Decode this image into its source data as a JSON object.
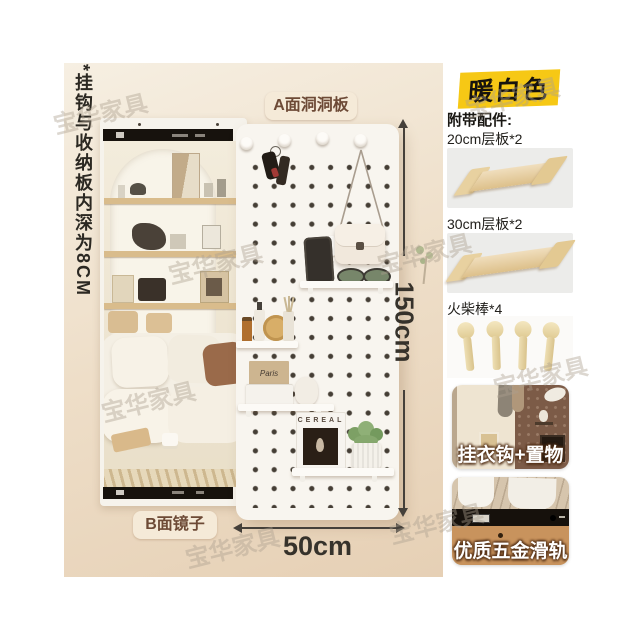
{
  "stage": {
    "side_note": "*挂钩与收纳板内深为8CM",
    "label_front": "A面洞洞板",
    "label_back": "B面镜子",
    "dim_height": "150cm",
    "dim_width": "50cm",
    "cereal_title": "CEREAL",
    "magazine_title": "Paris"
  },
  "sidebar": {
    "color_badge": "暖白色",
    "accessories_title": "附带配件:",
    "accessories": [
      {
        "label": "20cm层板*2"
      },
      {
        "label": "30cm层板*2"
      },
      {
        "label": "火柴棒*4"
      }
    ],
    "feature_cards": [
      {
        "label": "挂衣钩+置物"
      },
      {
        "label": "优质五金滑轨"
      }
    ]
  },
  "watermark": {
    "text": "宝华家具"
  },
  "colors": {
    "badge_yellow": "#F6C815",
    "stage_beige": "#EDDCC6",
    "label_badge_bg": "#F5EAD8",
    "label_badge_text": "#6D4A36",
    "pegboard_white": "#F8F5EF",
    "rail_black": "#17120D",
    "wood": "#DDBE86"
  }
}
